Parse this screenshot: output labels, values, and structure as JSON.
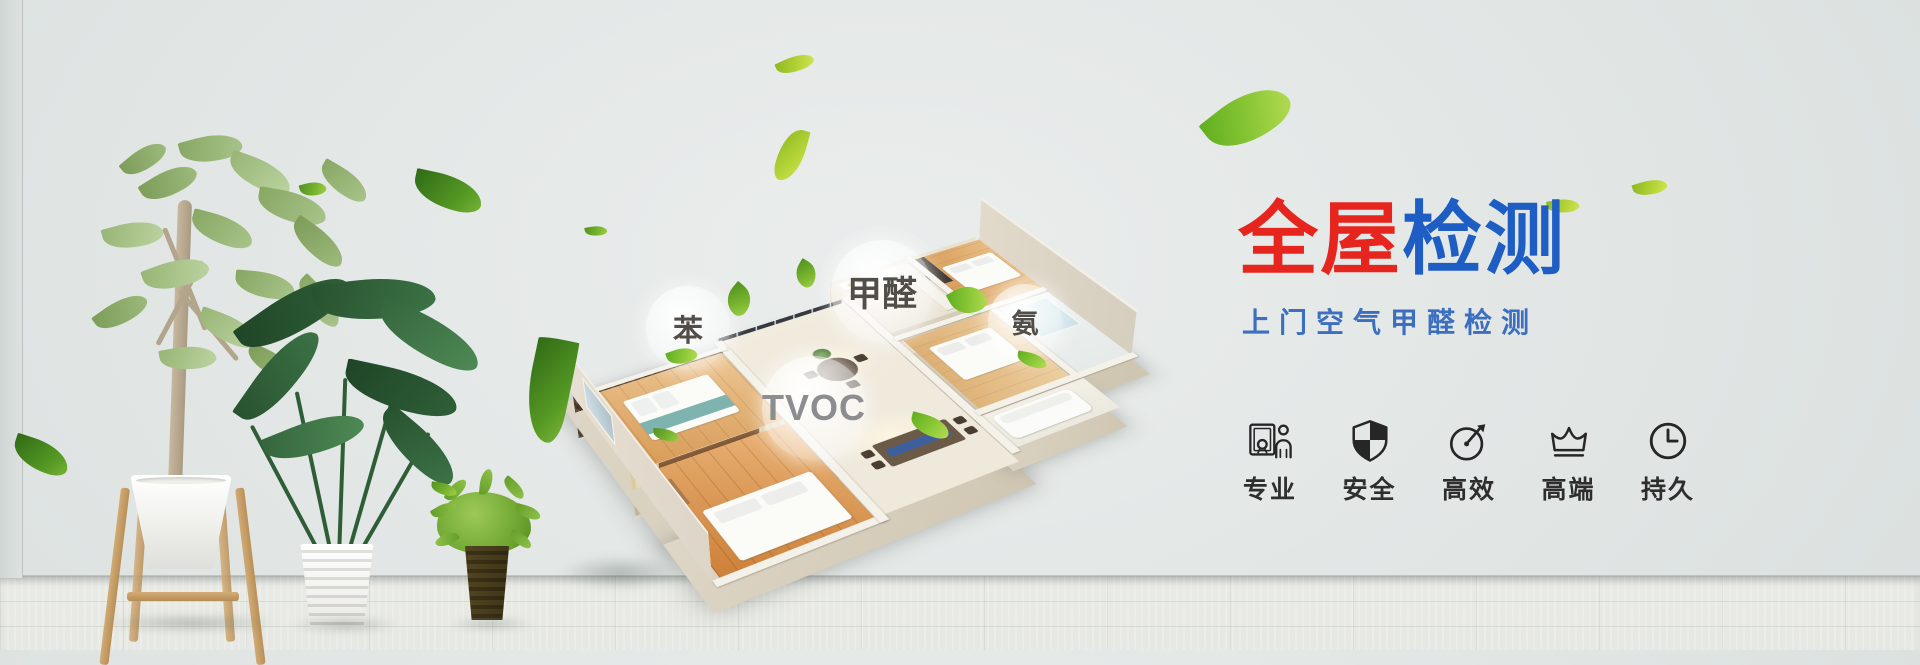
{
  "hero": {
    "title_red": "全屋",
    "title_blue": "检测",
    "subtitle": "上门空气甲醛检测"
  },
  "pollutants": {
    "benzene": "苯",
    "formaldehyde": "甲醛",
    "ammonia": "氨",
    "tvoc": "TVOC"
  },
  "features": [
    {
      "icon": "certificate-person-icon",
      "label": "专业"
    },
    {
      "icon": "shield-icon",
      "label": "安全"
    },
    {
      "icon": "gauge-arrow-icon",
      "label": "高效"
    },
    {
      "icon": "crown-icon",
      "label": "高端"
    },
    {
      "icon": "clock-icon",
      "label": "持久"
    }
  ],
  "colors": {
    "title_red": "#e6261e",
    "title_blue": "#1e5ec4",
    "subtitle_blue": "#3d6fc0",
    "icon_black": "#262626",
    "leaf_green": "#6fae2e",
    "wall_gray": "#e0e5e3"
  }
}
